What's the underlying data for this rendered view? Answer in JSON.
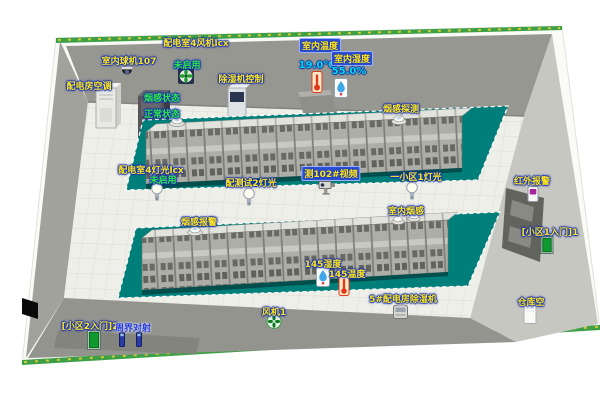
{
  "markers": {
    "fan4": {
      "label": "配电室4风机lcx",
      "status": "未启用"
    },
    "dome107": {
      "label": "室内球机107"
    },
    "ac": {
      "label": "配电房空调"
    },
    "dehum_ctrl": {
      "label": "除湿机控制"
    },
    "temp_indoor": {
      "label": "室内温度",
      "value": "19.0℃"
    },
    "hum_indoor": {
      "label": "室内湿度",
      "value": "55.0%"
    },
    "smoke_state": {
      "label": "烟感状态",
      "status": "正常状态"
    },
    "smoke_probe": {
      "label": "烟感探测"
    },
    "light4": {
      "label": "配电室4灯光lcx",
      "status": "未启用"
    },
    "light_test2": {
      "label": "配测试2灯光"
    },
    "cam102": {
      "label": "测102#视频"
    },
    "light_area1": {
      "label": "一小区1灯光"
    },
    "indoor_smoke": {
      "label": "室内烟感"
    },
    "smoke_alarm": {
      "label": "烟感报警"
    },
    "infrared": {
      "label": "红外报警"
    },
    "gate1": {
      "label": "[小区1入门]1"
    },
    "hum145": {
      "label": "145湿度"
    },
    "temp145": {
      "label": "145温度"
    },
    "dehum5": {
      "label": "5#配电房除湿机"
    },
    "storage": {
      "label": "仓库空"
    },
    "fan1": {
      "label": "风机1"
    },
    "gate2": {
      "label": "[小区2入门]2"
    },
    "perimeter": {
      "label": "周界对射"
    }
  },
  "icons": {
    "wall_fan": "dark housing with green fan blades",
    "green_fan": "green exhaust fan",
    "bulb": "light bulb",
    "smoke_detector": "ceiling smoke detector",
    "thermometer": "red thermometer",
    "humidity": "humidity sensor with blue drop",
    "dome_camera": "dome camera",
    "box_camera": "box cctv camera",
    "infrared": "infrared alarm unit with purple lens",
    "door": "green access door",
    "beam_post": "perimeter beam post",
    "dehumidifier": "dehumidifier unit",
    "storage_box": "white storage cabinet"
  },
  "colors": {
    "platform_teal": "#007e7a",
    "label_yellow": "#ffe61a",
    "status_green": "#30e842",
    "value_cyan": "#00d9f2",
    "label_box_blue": "#2b50d4",
    "wall_gray": "#979791",
    "floor_white": "#efefe9",
    "hedge_green": "#3da046"
  }
}
